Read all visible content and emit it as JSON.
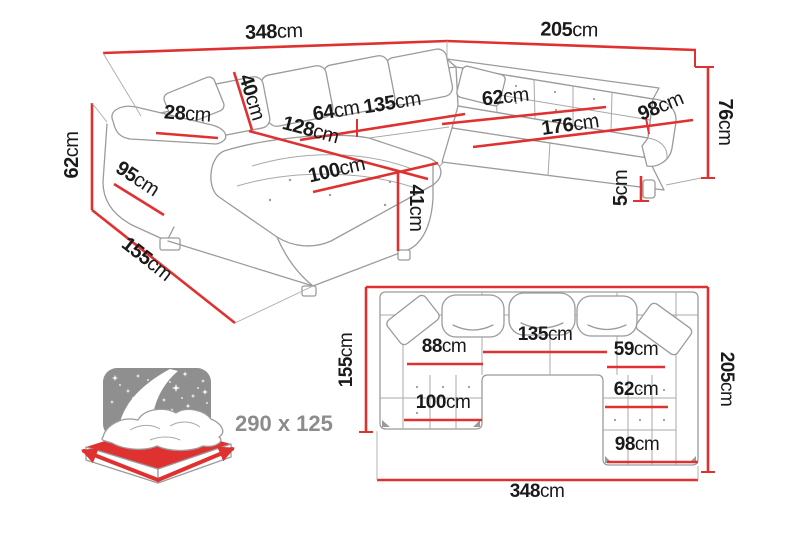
{
  "colors": {
    "dimension_red": "#e03131",
    "drawing_gray": "#9b9b9b",
    "label_black": "#1a1a1a",
    "muted_gray": "#8c8c8c",
    "background": "#ffffff"
  },
  "perspective_view": {
    "dims": {
      "width_left": {
        "value": "348",
        "unit": "cm"
      },
      "width_right": {
        "value": "205",
        "unit": "cm"
      },
      "backrest_height": {
        "value": "40",
        "unit": "cm"
      },
      "armrest_top_width": {
        "value": "28",
        "unit": "cm"
      },
      "seat_depth_left": {
        "value": "64",
        "unit": "cm"
      },
      "seat_width_middle": {
        "value": "135",
        "unit": "cm"
      },
      "chaise_length": {
        "value": "128",
        "unit": "cm"
      },
      "seat_depth_right": {
        "value": "62",
        "unit": "cm"
      },
      "seat_width_right": {
        "value": "176",
        "unit": "cm"
      },
      "armrest_depth_right": {
        "value": "98",
        "unit": "cm"
      },
      "total_height": {
        "value": "76",
        "unit": "cm"
      },
      "leg_height": {
        "value": "5",
        "unit": "cm"
      },
      "armrest_height": {
        "value": "62",
        "unit": "cm"
      },
      "armrest_length": {
        "value": "95",
        "unit": "cm"
      },
      "chaise_width": {
        "value": "100",
        "unit": "cm"
      },
      "seat_height": {
        "value": "41",
        "unit": "cm"
      },
      "chaise_depth": {
        "value": "155",
        "unit": "cm"
      }
    }
  },
  "sleeping_area": {
    "label": "290 x 125"
  },
  "plan_view": {
    "dims": {
      "left_depth": {
        "value": "155",
        "unit": "cm"
      },
      "left_seat_width": {
        "value": "88",
        "unit": "cm"
      },
      "middle_seat_width": {
        "value": "135",
        "unit": "cm"
      },
      "right_seat_width": {
        "value": "59",
        "unit": "cm"
      },
      "right_depth": {
        "value": "205",
        "unit": "cm"
      },
      "chaise_width": {
        "value": "100",
        "unit": "cm"
      },
      "right_section_width": {
        "value": "62",
        "unit": "cm"
      },
      "right_bottom_width": {
        "value": "98",
        "unit": "cm"
      },
      "total_width": {
        "value": "348",
        "unit": "cm"
      }
    }
  }
}
